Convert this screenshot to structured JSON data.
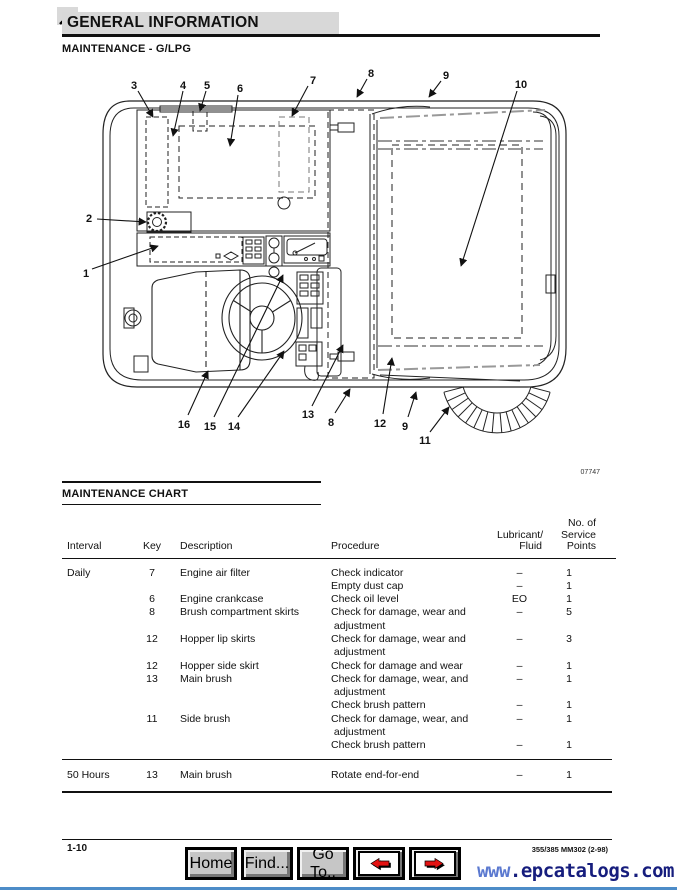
{
  "page": {
    "header_title": "GENERAL INFORMATION",
    "subtitle": "MAINTENANCE - G/LPG"
  },
  "diagram": {
    "fig_number": "07747",
    "callouts": [
      "3",
      "4",
      "5",
      "6",
      "7",
      "8",
      "9",
      "10",
      "2",
      "1",
      "16",
      "15",
      "14",
      "13",
      "8",
      "12",
      "9",
      "11"
    ]
  },
  "chart": {
    "section_title": "MAINTENANCE CHART",
    "columns": {
      "interval": "Interval",
      "key": "Key",
      "description": "Description",
      "procedure": "Procedure",
      "fluid": "Lubricant/\nFluid",
      "points": "No. of\nService\nPoints"
    },
    "sections": [
      {
        "rows": [
          {
            "interval": "Daily",
            "key": "7",
            "desc": "Engine air filter",
            "proc": "Check indicator",
            "fluid": "–",
            "points": "1"
          },
          {
            "proc": "Empty dust cap",
            "fluid": "–",
            "points": "1"
          },
          {
            "key": "6",
            "desc": "Engine crankcase",
            "proc": "Check oil level",
            "fluid": "EO",
            "points": "1"
          },
          {
            "key": "8",
            "desc": "Brush compartment skirts",
            "proc": "Check for damage, wear and",
            "fluid": "–",
            "points": "5"
          },
          {
            "proc": " adjustment"
          },
          {
            "key": "12",
            "desc": "Hopper lip skirts",
            "proc": "Check for damage, wear and",
            "fluid": "–",
            "points": "3"
          },
          {
            "proc": " adjustment"
          },
          {
            "key": "12",
            "desc": "Hopper side skirt",
            "proc": "Check for damage and wear",
            "fluid": "–",
            "points": "1"
          },
          {
            "key": "13",
            "desc": "Main brush",
            "proc": "Check for damage, wear, and",
            "fluid": "–",
            "points": "1"
          },
          {
            "proc": " adjustment"
          },
          {
            "proc": "Check brush pattern",
            "fluid": "–",
            "points": "1"
          },
          {
            "key": "11",
            "desc": "Side brush",
            "proc": "Check for damage, wear, and",
            "fluid": "–",
            "points": "1"
          },
          {
            "proc": " adjustment"
          },
          {
            "proc": "Check brush pattern",
            "fluid": "–",
            "points": "1"
          }
        ]
      },
      {
        "rows": [
          {
            "interval": "50 Hours",
            "key": "13",
            "desc": "Main brush",
            "proc": "Rotate end-for-end",
            "fluid": "–",
            "points": "1"
          }
        ]
      }
    ]
  },
  "footer": {
    "page_number": "1-10",
    "doc_ref": "355/385 MM302 (2-98)"
  },
  "toolbar": {
    "home_label": "Home",
    "find_label": "Find...",
    "goto_label": "Go To..",
    "back_icon": "red-arrow-left",
    "forward_icon": "red-arrow-right"
  },
  "watermark": {
    "prefix": "www",
    "suffix": ".epcatalogs.com"
  },
  "colors": {
    "header_bar_gray": "#d8d8d8",
    "accent_blue": "#4d8cc8",
    "watermark_navy": "#161d7d",
    "arrow_red": "#e31212"
  }
}
